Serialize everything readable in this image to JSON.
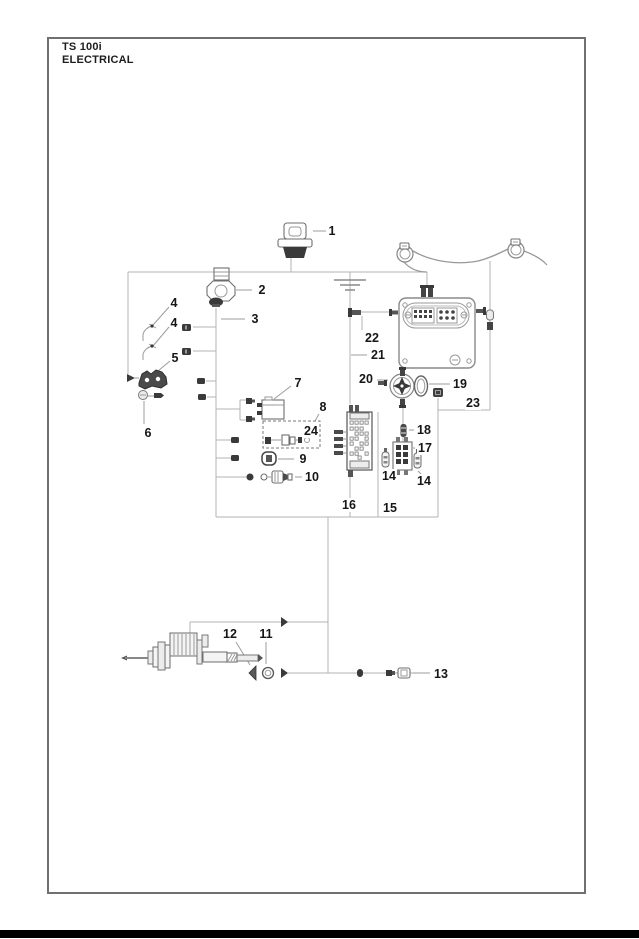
{
  "header": {
    "model": "TS 100i",
    "section": "ELECTRICAL"
  },
  "colors": {
    "line": "#b3b3b3",
    "leader": "#9c9c9c",
    "label": "#161616",
    "border": "#707070",
    "footer": "#000000",
    "stroke": "#6f6f6f",
    "dark": "#3a3a3a"
  },
  "callouts": [
    {
      "n": "1",
      "x": 332,
      "y": 231
    },
    {
      "n": "2",
      "x": 262,
      "y": 290
    },
    {
      "n": "3",
      "x": 255,
      "y": 319
    },
    {
      "n": "4",
      "x": 174,
      "y": 303
    },
    {
      "n": "4",
      "x": 174,
      "y": 323
    },
    {
      "n": "5",
      "x": 175,
      "y": 358
    },
    {
      "n": "6",
      "x": 148,
      "y": 433
    },
    {
      "n": "7",
      "x": 298,
      "y": 383
    },
    {
      "n": "8",
      "x": 323,
      "y": 407
    },
    {
      "n": "24",
      "x": 311,
      "y": 431
    },
    {
      "n": "9",
      "x": 303,
      "y": 459
    },
    {
      "n": "10",
      "x": 312,
      "y": 477
    },
    {
      "n": "12",
      "x": 230,
      "y": 634
    },
    {
      "n": "11",
      "x": 266,
      "y": 634
    },
    {
      "n": "13",
      "x": 441,
      "y": 674
    },
    {
      "n": "14",
      "x": 389,
      "y": 476
    },
    {
      "n": "14",
      "x": 424,
      "y": 481
    },
    {
      "n": "15",
      "x": 390,
      "y": 508
    },
    {
      "n": "16",
      "x": 349,
      "y": 505
    },
    {
      "n": "17",
      "x": 425,
      "y": 448
    },
    {
      "n": "18",
      "x": 424,
      "y": 430
    },
    {
      "n": "19",
      "x": 460,
      "y": 384
    },
    {
      "n": "20",
      "x": 366,
      "y": 379
    },
    {
      "n": "21",
      "x": 378,
      "y": 355
    },
    {
      "n": "22",
      "x": 372,
      "y": 338
    },
    {
      "n": "23",
      "x": 473,
      "y": 403
    }
  ]
}
